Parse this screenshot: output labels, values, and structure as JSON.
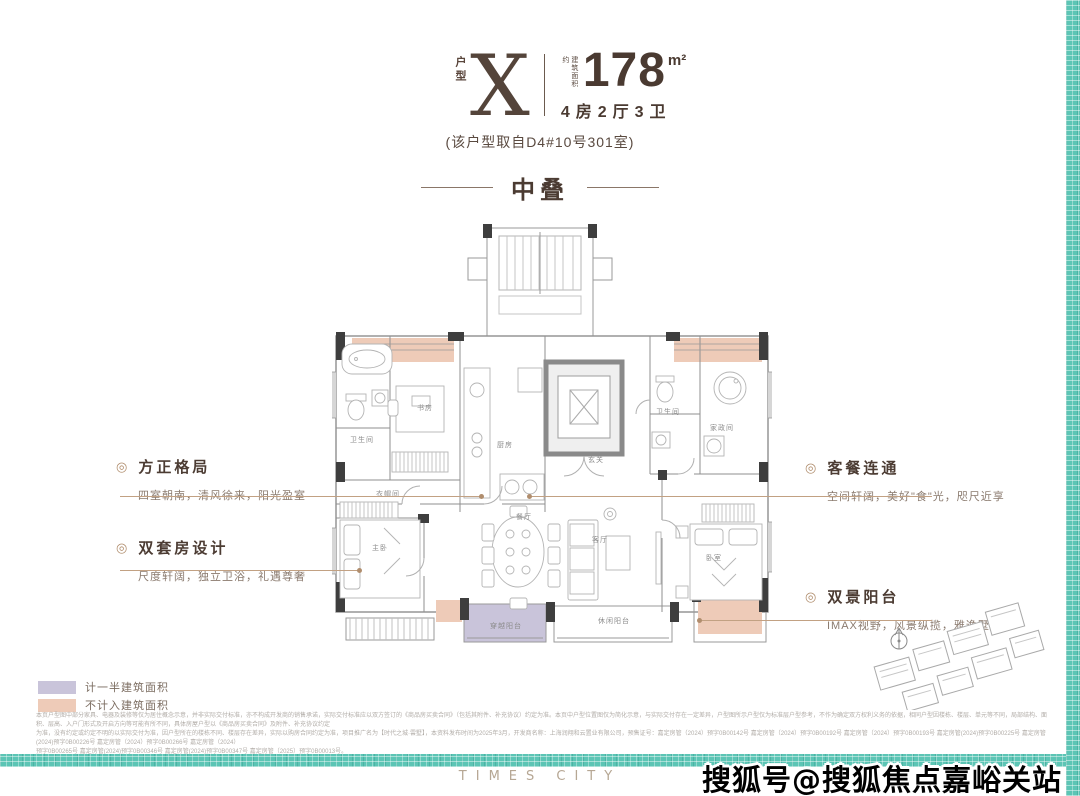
{
  "header": {
    "type_label": "户型",
    "type_letter": "X",
    "area_prefix": "建筑面积约",
    "area_value": "178",
    "area_unit": "m²",
    "rooms": "4房2厅3卫",
    "source_note": "(该户型取自D4#10号301室)"
  },
  "section_title": "中叠",
  "annotations": {
    "left": [
      {
        "title": "方正格局",
        "desc": "四室朝南，清风徐来，阳光盈室"
      },
      {
        "title": "双套房设计",
        "desc": "尺度轩阔，独立卫浴，礼遇尊奢"
      }
    ],
    "right": [
      {
        "title": "客餐连通",
        "desc": "空间轩阔，美好\"食\"光，咫尺近享"
      },
      {
        "title": "双景阳台",
        "desc": "IMAX视野，风景纵揽，雅逸墅居"
      }
    ],
    "icon": "◎"
  },
  "floor_plan": {
    "labels": {
      "bath1": "卫生间",
      "study": "书房",
      "kitchen": "厨房",
      "foyer": "玄关",
      "bath2": "卫生间",
      "util": "家政间",
      "cloak": "衣帽间",
      "dining": "餐厅",
      "living": "客厅",
      "master": "主卧",
      "bed2": "卧室",
      "balcony_left": "穿越阳台",
      "balcony_mid": "休闲阳台"
    }
  },
  "legend": [
    {
      "label": "计一半建筑面积",
      "color": "#c9c4da"
    },
    {
      "label": "不计入建筑面积",
      "color": "#eecbb8"
    }
  ],
  "disclaimer_lines": [
    "本页户型图中部分家具、电器及装修等仅为居住概念示意，并非实际交付标准，亦不构成开发商的销售承诺，实际交付标准应以双方签订的《商品房买卖合同》（包括其附件、补充协议）约定为准。本页中户型位置图仅为简化示意，与实际交付存在一定差异，户型图所示户型仅为标准层户型参考，不作为确定双方权利义务的依据，相同户型因楼栋、楼层、单元等不同，局部结构、面积、层高、入户门形式及开启方向等可能有所不同，具体房屋户型以《商品房买卖合同》及附件、补充协议约定",
    "为准，没有约定或约定不明的以实际交付为准，因户型所在的楼栋不同、楼层存在差异，实际以购房合同约定为准，项目推广名为【时代之城·雲墅】，本资料发布时间为2025年3月，开发商名称：上海润翔和云置业有限公司，预售证号：嘉定房管（2024）预字0B00142号 嘉定房管（2024）预字0B00192号 嘉定房管（2024）预字0B00193号 嘉定房管(2024)预字0B00225号 嘉定房管(2024)预字0B00226号 嘉定房管（2024）预字0B00266号 嘉定房管（2024）",
    "预字0B00265号 嘉定房管(2024)预字0B00346号 嘉定房管(2024)预字0B00347号 嘉定房管（2025）预字0B00013号。"
  ],
  "footer": {
    "logo": "TIMES CITY",
    "watermark": "搜狐号@搜狐焦点嘉峪关站"
  },
  "colors": {
    "accent_brown": "#5a463c",
    "tan_line": "#c2a183",
    "salmon": "#eecbb8",
    "lavender": "#c9c4da",
    "teal": "#5cc5b5"
  }
}
